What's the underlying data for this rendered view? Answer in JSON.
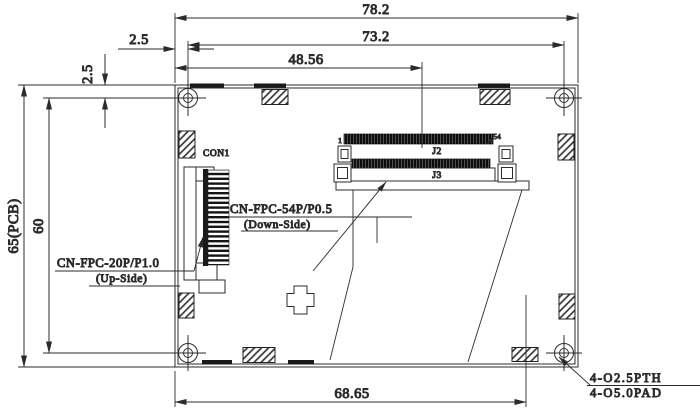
{
  "drawing": {
    "dimensions": {
      "top_width": "78.2",
      "inner_width": "73.2",
      "j2_offset": "48.56",
      "left_offset_h": "2.5",
      "left_offset_v": "2.5",
      "pcb_height": "65(PCB)",
      "inner_height": "60",
      "bottom_width": "68.65"
    },
    "labels": {
      "con1": "CON1",
      "j2": "J2",
      "j3": "J3",
      "pin_first": "1",
      "pin_last": "54",
      "connector54": "CN-FPC-54P/P0.5",
      "connector54_side": "(Down-Side)",
      "connector20": "CN-FPC-20P/P1.0",
      "connector20_side": "(Up-Side)"
    },
    "notes": {
      "hole_note_line1": "4-O2.5PTH",
      "hole_note_line2": "4-O5.0PAD"
    },
    "colors": {
      "line": "#2b2b2b",
      "text": "#23234f",
      "background": "#ffffff"
    }
  }
}
